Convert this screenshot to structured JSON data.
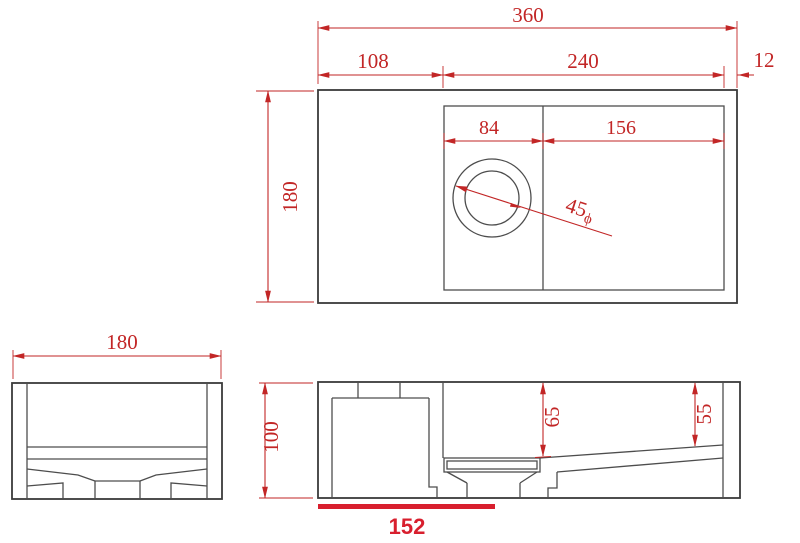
{
  "drawing": {
    "background_color": "#ffffff",
    "line_color": "#4d4d4d",
    "outline_color": "#3a3a3a",
    "dimension_color": "#c22626",
    "highlight_color": "#d81f2e",
    "top_view": {
      "width_total": "360",
      "width_left_section": "108",
      "width_basin_section": "240",
      "width_right_edge": "12",
      "basin_left_width": "84",
      "basin_right_width": "156",
      "depth": "180",
      "drain_diameter_value": "45",
      "drain_diameter_symbol": "ϕ"
    },
    "side_view": {
      "width": "180"
    },
    "front_view": {
      "height": "100",
      "depth_at_drain": "65",
      "depth_at_right_end": "55",
      "highlighted_length": "152"
    }
  }
}
